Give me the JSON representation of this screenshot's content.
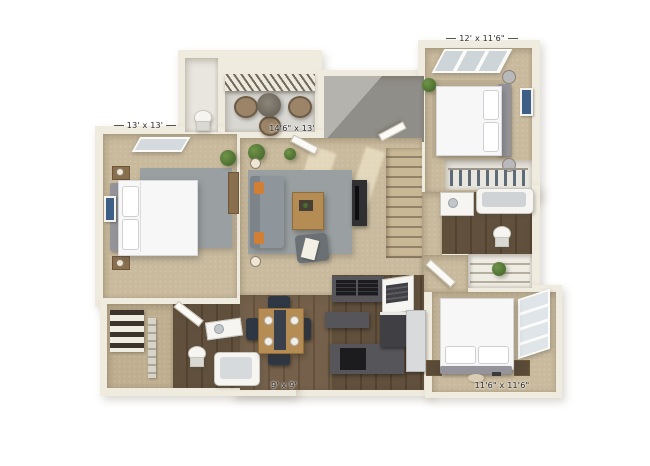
{
  "floorplan": {
    "title": "3D apartment floor plan render",
    "labels": {
      "master_bedroom": "13' x 13'",
      "living_room": "14'6\" x 13'",
      "bedroom_2": "12' x 11'6\"",
      "dining": "9' x 9'",
      "bedroom_3": "11'6\" x 11'6\""
    },
    "colors": {
      "background": "#ffffff",
      "wall": "#f0ebdf",
      "wall_shadow": "#d9d2c1",
      "carpet": "#c9ba9d",
      "wood_floor": "#73604a",
      "balcony_floor": "#d8d7d2",
      "stairwell_gray": "#8f8e89",
      "rug_gray": "#9aa0a2",
      "sofa_gray": "#8f969b",
      "accent_orange": "#d07f35",
      "bed_white": "#f7f7f8",
      "counter_dark": "#55555a",
      "appliance_black": "#1c1c1f",
      "dining_chair_navy": "#2e3744",
      "table_wood": "#b68c55",
      "plant_green": "#557a38",
      "art_blue": "#3e5f85"
    }
  }
}
